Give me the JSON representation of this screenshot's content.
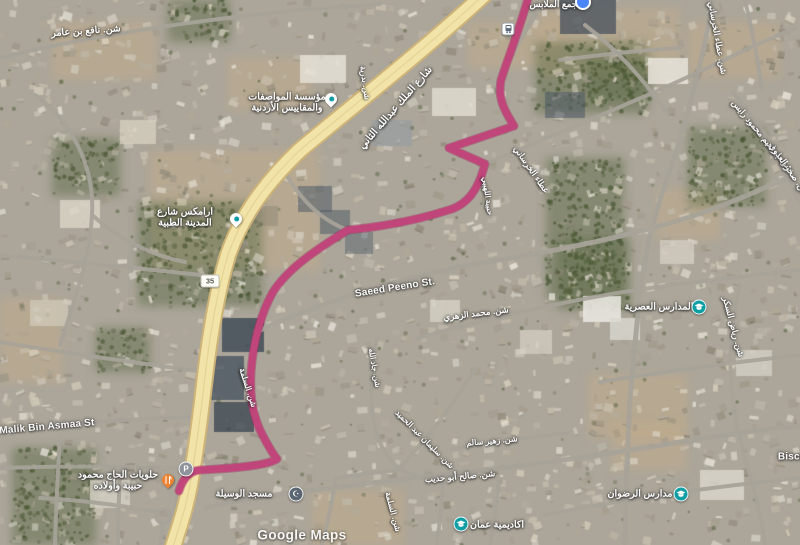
{
  "map": {
    "watermark": "Google Maps",
    "colors": {
      "route": "#c2437a",
      "route_casing": "#a02f63",
      "highway_fill": "#f2e4a9",
      "highway_casing": "#cdb377",
      "highway_median": "#e0cf8e",
      "road": "#a8a39a",
      "label_text": "#ffffff",
      "poi_teal": "#129da5",
      "poi_orange": "#ee8434",
      "mosque_slate": "#5a6572",
      "school_teal": "#0f9ea4",
      "parking_gray": "#8d929b",
      "transit_blue": "#4a86f7"
    },
    "street_labels": [
      {
        "name": "street-label-nafi-bin-amer",
        "text": "شن. نافع بن عامر",
        "x": 86,
        "y": 32,
        "rot": -4,
        "size": 9.5
      },
      {
        "name": "street-label-king-abdullah-ii",
        "text": "شارع الملك عبدالله الثاني",
        "x": 396,
        "y": 108,
        "rot": -49,
        "size": 10
      },
      {
        "name": "street-label-badriya",
        "text": "شن. بدرية",
        "x": 364,
        "y": 83,
        "rot": 82,
        "size": 8
      },
      {
        "name": "street-label-ataa-khursani-top",
        "text": "شن. عطاء الخرساني",
        "x": 717,
        "y": 38,
        "rot": 80,
        "size": 8.5
      },
      {
        "name": "street-label-ataa-khursani-mid",
        "text": "عطاء الخرساني",
        "x": 531,
        "y": 170,
        "rot": 55,
        "size": 8.5
      },
      {
        "name": "street-label-ibrahim-mahmoud-rais",
        "text": "شن. إبراهيم محمود رايس",
        "x": 762,
        "y": 136,
        "rot": 50,
        "size": 8.5
      },
      {
        "name": "street-label-sakhr-adawi",
        "text": "شن. صخر العدوي",
        "x": 789,
        "y": 170,
        "rot": 55,
        "size": 8.5
      },
      {
        "name": "street-label-saeed-peeno",
        "text": "Saeed Peeno St.",
        "x": 395,
        "y": 288,
        "rot": -9,
        "size": 10
      },
      {
        "name": "street-label-mohammad-zuhri",
        "text": "شن. محمد الزهري",
        "x": 476,
        "y": 314,
        "rot": -7,
        "size": 8.5
      },
      {
        "name": "street-label-habiba",
        "text": "حبيبة اللهيبي",
        "x": 487,
        "y": 196,
        "rot": 82,
        "size": 7.5
      },
      {
        "name": "street-label-malik-bin-asmaa",
        "text": "Malik Bin Asmaa St",
        "x": 47,
        "y": 427,
        "rot": -5,
        "size": 10
      },
      {
        "name": "street-label-salma-1",
        "text": "شن. السلمة",
        "x": 247,
        "y": 388,
        "rot": 72,
        "size": 8
      },
      {
        "name": "street-label-salma-2",
        "text": "شن. السلمة",
        "x": 392,
        "y": 512,
        "rot": 75,
        "size": 8
      },
      {
        "name": "street-label-jadallah",
        "text": "شن. جاد الله",
        "x": 374,
        "y": 368,
        "rot": 80,
        "size": 7.5
      },
      {
        "name": "street-label-suleiman-abd",
        "text": "شن. سليمان عبد الحميد",
        "x": 424,
        "y": 440,
        "rot": 45,
        "size": 8
      },
      {
        "name": "street-label-saleh-abu-hudaib",
        "text": "شن. صالح أبو حديب",
        "x": 460,
        "y": 477,
        "rot": -5,
        "size": 8.5
      },
      {
        "name": "street-label-zuhair-salem",
        "text": "شن. زهير سالم",
        "x": 492,
        "y": 442,
        "rot": -5,
        "size": 8
      },
      {
        "name": "street-label-riyad-sukkar",
        "text": "شن. رياض السكر",
        "x": 733,
        "y": 327,
        "rot": 75,
        "size": 8.5
      },
      {
        "name": "street-label-biscu",
        "text": "Biscu",
        "x": 792,
        "y": 457,
        "rot": 0,
        "size": 10
      }
    ],
    "pois": [
      {
        "name": "poi-jsmo",
        "lines": [
          "مؤسسة المواصفات",
          "والمقاييس الأردنية"
        ],
        "tx": 287,
        "ty": 103,
        "icon": "pin-generic",
        "ix": 331,
        "iy": 99,
        "size": 9.5
      },
      {
        "name": "poi-aramex-medical-city",
        "lines": [
          "ارامكس شارع",
          "المدينة الطبية"
        ],
        "tx": 185,
        "ty": 218,
        "icon": "pin-generic",
        "ix": 236,
        "iy": 219,
        "size": 9.5
      },
      {
        "name": "poi-halawiyat-hajj-mahmoud",
        "lines": [
          "حلويات الحاج محمود",
          "حبيبة وأولاده"
        ],
        "tx": 118,
        "ty": 481,
        "icon": "pin-restaurant",
        "ix": 168,
        "iy": 480,
        "size": 9.5
      },
      {
        "name": "poi-masjid-al-wasila",
        "lines": [
          "مسجد الوسيلة"
        ],
        "tx": 244,
        "ty": 495,
        "icon": "circle-mosque",
        "ix": 296,
        "iy": 494,
        "size": 9.5
      },
      {
        "name": "poi-amman-academy",
        "lines": [
          "اكاديمية عمان"
        ],
        "tx": 497,
        "ty": 526,
        "icon": "circle-school",
        "ix": 461,
        "iy": 524,
        "size": 9.5
      },
      {
        "name": "poi-radwan-schools",
        "lines": [
          "مدارس الرضوان"
        ],
        "tx": 640,
        "ty": 495,
        "icon": "circle-school",
        "ix": 681,
        "iy": 494,
        "size": 9.5
      },
      {
        "name": "poi-modern-schools",
        "lines": [
          "المدارس العصرية"
        ],
        "tx": 659,
        "ty": 308,
        "icon": "circle-school",
        "ix": 699,
        "iy": 307,
        "size": 9.5
      },
      {
        "name": "poi-majmaa",
        "lines": [
          "مجمع الملابس"
        ],
        "tx": 556,
        "ty": 4,
        "icon": "dot-blue",
        "ix": 583,
        "iy": 2,
        "size": 9
      }
    ],
    "markers": [
      {
        "name": "parking-icon",
        "type": "parking",
        "glyph": "P",
        "x": 186,
        "y": 469
      },
      {
        "name": "bus-stop-icon",
        "type": "bus",
        "x": 508,
        "y": 29
      },
      {
        "name": "route-shield-35",
        "type": "shield",
        "text": "35",
        "x": 210,
        "y": 281
      }
    ]
  }
}
